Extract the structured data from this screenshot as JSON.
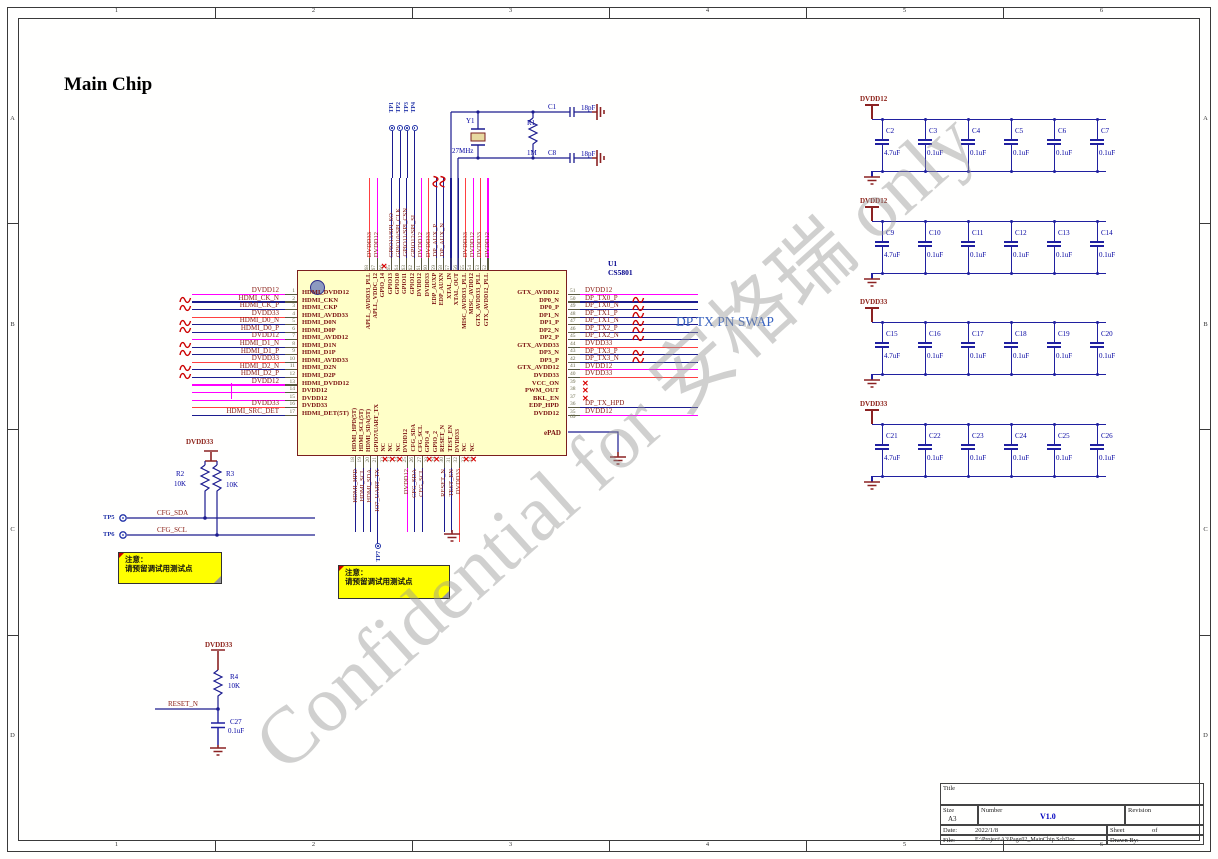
{
  "sheet": {
    "cols": [
      "1",
      "2",
      "3",
      "4",
      "5",
      "6"
    ],
    "rows": [
      "A",
      "B",
      "C",
      "D"
    ]
  },
  "title": "Main Chip",
  "watermark": "Confidential for 安格瑞 only",
  "dp_swap_note": "DP TX PN SWAP",
  "chip": {
    "ref": "U1",
    "part": "CS5801",
    "epad_name": "ePAD",
    "epad_num": "69",
    "left_pins": [
      {
        "num": "1",
        "inner": "HDMI_DVDD12",
        "net": "DVDD12",
        "cls": "pwr12"
      },
      {
        "num": "2",
        "inner": "HDMI_CKN",
        "net": "HDMI_CK_N",
        "cls": "sig diff"
      },
      {
        "num": "3",
        "inner": "HDMI_CKP",
        "net": "HDMI_CK_P",
        "cls": "sig diff"
      },
      {
        "num": "4",
        "inner": "HDMI_AVDD33",
        "net": "DVDD33",
        "cls": "pwr33"
      },
      {
        "num": "5",
        "inner": "HDMI_D0N",
        "net": "HDMI_D0_N",
        "cls": "sig diff"
      },
      {
        "num": "6",
        "inner": "HDMI_D0P",
        "net": "HDMI_D0_P",
        "cls": "sig diff"
      },
      {
        "num": "7",
        "inner": "HDMI_AVDD12",
        "net": "DVDD12",
        "cls": "pwr12"
      },
      {
        "num": "8",
        "inner": "HDMI_D1N",
        "net": "HDMI_D1_N",
        "cls": "sig diff"
      },
      {
        "num": "9",
        "inner": "HDMI_D1P",
        "net": "HDMI_D1_P",
        "cls": "sig diff"
      },
      {
        "num": "10",
        "inner": "HDMI_AVDD33",
        "net": "DVDD33",
        "cls": "pwr33"
      },
      {
        "num": "11",
        "inner": "HDMI_D2N",
        "net": "HDMI_D2_N",
        "cls": "sig diff"
      },
      {
        "num": "12",
        "inner": "HDMI_D2P",
        "net": "HDMI_D2_P",
        "cls": "sig diff"
      },
      {
        "num": "13",
        "inner": "HDMI_DVDD12",
        "net": "DVDD12",
        "cls": "pwr12"
      },
      {
        "num": "14",
        "inner": "DVDD12",
        "net": "",
        "cls": "pwr12"
      },
      {
        "num": "15",
        "inner": "DVDD12",
        "net": "",
        "cls": "pwr12"
      },
      {
        "num": "16",
        "inner": "DVDD33",
        "net": "DVDD33",
        "cls": "pwr33"
      },
      {
        "num": "17",
        "inner": "HDMI_DET(5T)",
        "net": "HDMI_SRC_DET",
        "cls": "sig"
      }
    ],
    "right_pins": [
      {
        "num": "51",
        "inner": "GTX_AVDD12",
        "net": "DVDD12",
        "cls": "pwr12"
      },
      {
        "num": "50",
        "inner": "DP0_N",
        "net": "DP_TX0_P",
        "cls": "sig diff"
      },
      {
        "num": "49",
        "inner": "DP0_P",
        "net": "DP_TX0_N",
        "cls": "sig diff"
      },
      {
        "num": "48",
        "inner": "DP1_N",
        "net": "DP_TX1_P",
        "cls": "sig diff"
      },
      {
        "num": "47",
        "inner": "DP1_P",
        "net": "DP_TX1_N",
        "cls": "sig diff"
      },
      {
        "num": "46",
        "inner": "DP2_N",
        "net": "DP_TX2_P",
        "cls": "sig diff"
      },
      {
        "num": "45",
        "inner": "DP2_P",
        "net": "DP_TX2_N",
        "cls": "sig diff"
      },
      {
        "num": "44",
        "inner": "GTX_AVDD33",
        "net": "DVDD33",
        "cls": "pwr33"
      },
      {
        "num": "43",
        "inner": "DP3_N",
        "net": "DP_TX3_P",
        "cls": "sig diff"
      },
      {
        "num": "42",
        "inner": "DP3_P",
        "net": "DP_TX3_N",
        "cls": "sig diff"
      },
      {
        "num": "41",
        "inner": "GTX_AVDD12",
        "net": "DVDD12",
        "cls": "pwr12"
      },
      {
        "num": "40",
        "inner": "DVDD33",
        "net": "DVDD33",
        "cls": "pwr33"
      },
      {
        "num": "39",
        "inner": "VCC_ON",
        "net": "",
        "cls": "nc"
      },
      {
        "num": "38",
        "inner": "PWM_OUT",
        "net": "",
        "cls": "nc"
      },
      {
        "num": "37",
        "inner": "BKL_EN",
        "net": "",
        "cls": "nc"
      },
      {
        "num": "36",
        "inner": "EDP_HPD",
        "net": "DP_TX_HPD",
        "cls": "sig"
      },
      {
        "num": "35",
        "inner": "DVDD12",
        "net": "DVDD12",
        "cls": "pwr12"
      }
    ],
    "top_pins": [
      {
        "num": "68",
        "inner": "APLL_AVDD33_PLL",
        "net": "DVDD33",
        "cls": "pwr33"
      },
      {
        "num": "67",
        "inner": "APLL_VDDC_12",
        "net": "DVDD12",
        "cls": "pwr12"
      },
      {
        "num": "66",
        "inner": "GPIO_14",
        "net": "",
        "cls": "nc"
      },
      {
        "num": "65",
        "inner": "GPIO13",
        "net": "GPIO13/SPI_SO",
        "cls": "sig"
      },
      {
        "num": "64",
        "inner": "GPIO10",
        "net": "GPIO10/SPI_CLK",
        "cls": "sig"
      },
      {
        "num": "63",
        "inner": "GPIO11",
        "net": "GPIO11/SPI_CSN",
        "cls": "sig"
      },
      {
        "num": "62",
        "inner": "GPIO12",
        "net": "GPIO12/SPI_SI",
        "cls": "sig"
      },
      {
        "num": "61",
        "inner": "DVDD12",
        "net": "DVDD12",
        "cls": "pwr12"
      },
      {
        "num": "60",
        "inner": "DVDD33",
        "net": "DVDD33",
        "cls": "pwr33"
      },
      {
        "num": "59",
        "inner": "EDP_AUXP",
        "net": "DP_AUX_P",
        "cls": "sig diff"
      },
      {
        "num": "58",
        "inner": "EDP_AUXN",
        "net": "DP_AUX_N",
        "cls": "sig diff"
      },
      {
        "num": "57",
        "inner": "XTAL_IN",
        "net": "",
        "cls": "sig"
      },
      {
        "num": "56",
        "inner": "XTAL_OUT",
        "net": "",
        "cls": "sig"
      },
      {
        "num": "55",
        "inner": "MISC_AVDD33_PLL",
        "net": "DVDD33",
        "cls": "pwr33"
      },
      {
        "num": "54",
        "inner": "MISC_AVDD12",
        "net": "DVDD12",
        "cls": "pwr12"
      },
      {
        "num": "53",
        "inner": "GTX_AVDD33_PLL",
        "net": "DVDD33",
        "cls": "pwr33"
      },
      {
        "num": "52",
        "inner": "GTX_AVDD12_PLL",
        "net": "DVDD12",
        "cls": "pwr12"
      }
    ],
    "bottom_pins": [
      {
        "num": "18",
        "inner": "HDMI_HPD(5T)",
        "net": "HDMI_HPD",
        "cls": "sig"
      },
      {
        "num": "19",
        "inner": "HDMI_SCL(5T)",
        "net": "HDMI_SCL",
        "cls": "sig"
      },
      {
        "num": "20",
        "inner": "HDMI_SDA(5T)",
        "net": "HDMI_SDA",
        "cls": "sig"
      },
      {
        "num": "21",
        "inner": "GPIO7/UART_TX",
        "net": "IO7_UART_TX",
        "cls": "sig tp"
      },
      {
        "num": "22",
        "inner": "NC",
        "net": "",
        "cls": "nc"
      },
      {
        "num": "23",
        "inner": "NC",
        "net": "",
        "cls": "nc"
      },
      {
        "num": "24",
        "inner": "NC",
        "net": "",
        "cls": "nc"
      },
      {
        "num": "25",
        "inner": "DVDD12",
        "net": "DVDD12",
        "cls": "pwr12"
      },
      {
        "num": "26",
        "inner": "CFG_SDA",
        "net": "CFG_SDA",
        "cls": "sig"
      },
      {
        "num": "27",
        "inner": "CFG_SCL",
        "net": "CFG_SCL",
        "cls": "sig"
      },
      {
        "num": "28",
        "inner": "GPIO_4",
        "net": "",
        "cls": "nc"
      },
      {
        "num": "29",
        "inner": "GPIO_2",
        "net": "",
        "cls": "nc"
      },
      {
        "num": "30",
        "inner": "RESET_N",
        "net": "RESET_N",
        "cls": "sig"
      },
      {
        "num": "31",
        "inner": "TEST_EN",
        "net": "TEST_EN",
        "cls": "sig"
      },
      {
        "num": "32",
        "inner": "DVDD33",
        "net": "DVDD33",
        "cls": "pwr33"
      },
      {
        "num": "33",
        "inner": "NC",
        "net": "",
        "cls": "nc"
      },
      {
        "num": "34",
        "inner": "NC",
        "net": "",
        "cls": "nc"
      }
    ]
  },
  "testpoints": {
    "top": [
      "TP1",
      "TP2",
      "TP3",
      "TP4"
    ],
    "tp5": "TP5",
    "tp6": "TP6",
    "tp7": "TP7"
  },
  "crystal": {
    "y1": "Y1",
    "freq": "27MHz",
    "r1": "R1",
    "r1_val": "1M",
    "c1": "C1",
    "c1_val": "18pF",
    "c8": "C8",
    "c8_val": "18pF"
  },
  "pullups": {
    "power": "DVDD33",
    "r2": "R2",
    "r2_val": "10K",
    "r3": "R3",
    "r3_val": "10K",
    "sda": "CFG_SDA",
    "scl": "CFG_SCL"
  },
  "reset": {
    "power": "DVDD33",
    "r4": "R4",
    "r4_val": "10K",
    "net": "RESET_N",
    "c27": "C27",
    "c27_val": "0.1uF"
  },
  "note": {
    "line1": "注意：",
    "line2": "请预留调试用测试点"
  },
  "cap_banks": [
    {
      "power": "DVDD12",
      "caps": [
        {
          "ref": "C2",
          "val": "4.7uF"
        },
        {
          "ref": "C3",
          "val": "0.1uF"
        },
        {
          "ref": "C4",
          "val": "0.1uF"
        },
        {
          "ref": "C5",
          "val": "0.1uF"
        },
        {
          "ref": "C6",
          "val": "0.1uF"
        },
        {
          "ref": "C7",
          "val": "0.1uF"
        }
      ]
    },
    {
      "power": "DVDD12",
      "caps": [
        {
          "ref": "C9",
          "val": "4.7uF"
        },
        {
          "ref": "C10",
          "val": "0.1uF"
        },
        {
          "ref": "C11",
          "val": "0.1uF"
        },
        {
          "ref": "C12",
          "val": "0.1uF"
        },
        {
          "ref": "C13",
          "val": "0.1uF"
        },
        {
          "ref": "C14",
          "val": "0.1uF"
        }
      ]
    },
    {
      "power": "DVDD33",
      "caps": [
        {
          "ref": "C15",
          "val": "4.7uF"
        },
        {
          "ref": "C16",
          "val": "0.1uF"
        },
        {
          "ref": "C17",
          "val": "0.1uF"
        },
        {
          "ref": "C18",
          "val": "0.1uF"
        },
        {
          "ref": "C19",
          "val": "0.1uF"
        },
        {
          "ref": "C20",
          "val": "0.1uF"
        }
      ]
    },
    {
      "power": "DVDD33",
      "caps": [
        {
          "ref": "C21",
          "val": "4.7uF"
        },
        {
          "ref": "C22",
          "val": "0.1uF"
        },
        {
          "ref": "C23",
          "val": "0.1uF"
        },
        {
          "ref": "C24",
          "val": "0.1uF"
        },
        {
          "ref": "C25",
          "val": "0.1uF"
        },
        {
          "ref": "C26",
          "val": "0.1uF"
        }
      ]
    }
  ],
  "titleblock": {
    "title_label": "Title",
    "size_label": "Size",
    "size": "A3",
    "number_label": "Number",
    "number": "V1.0",
    "revision_label": "Revision",
    "date_label": "Date:",
    "date": "2022/1/8",
    "sheet_label": "Sheet",
    "of_label": "of",
    "file_label": "File:",
    "file": "E:\\Project\\A3\\Page02_MainChip.SchDoc",
    "drawn_label": "Drawn By:"
  },
  "colors": {
    "wire_signal": "#1C1C8F",
    "wire_dvdd12": "#FF00FF",
    "wire_dvdd33": "#FF4040",
    "chip_fill": "#FFFFC8",
    "chip_border": "#7B1F1F",
    "net_text": "#8B2017",
    "designator_text": "#0000A0",
    "note_bg": "#FFFF00"
  }
}
